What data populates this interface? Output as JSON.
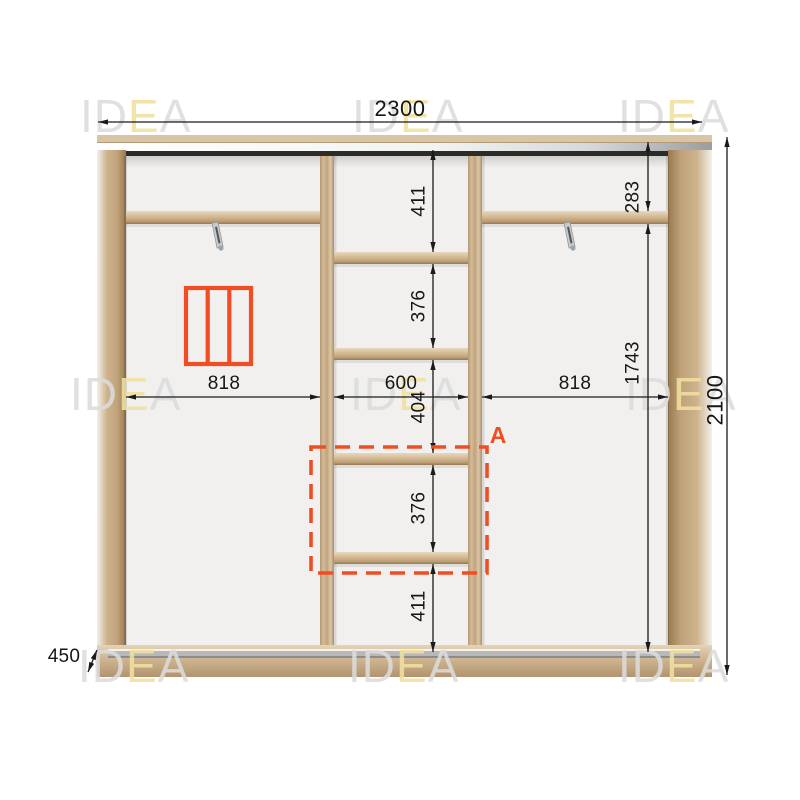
{
  "watermark": {
    "part_id": "ID",
    "part_e": "E",
    "part_a": "A",
    "gray_color": "#dcdcdc",
    "e_color": "#f0e1a0"
  },
  "colors": {
    "accent": "#f04e22",
    "dim_line": "#1a1a1a",
    "wood_mid": "#cbb190",
    "interior_bg": "#f1f0ee",
    "track_dark": "#2d2b27",
    "track_metal": "#b6b8ba"
  },
  "dimensions": {
    "total_width": "2300",
    "total_height": "2100",
    "depth": "450",
    "left_section_width": "818",
    "center_section_width": "600",
    "right_section_width": "818",
    "right_top_height": "283",
    "right_side_height": "1743",
    "center_top_height": "411",
    "center_upper_shelf_gap": "376",
    "center_middle_gap": "404",
    "center_lower_shelf_gap": "376",
    "center_bottom_height": "411"
  },
  "labels": {
    "detail_marker": "A"
  }
}
